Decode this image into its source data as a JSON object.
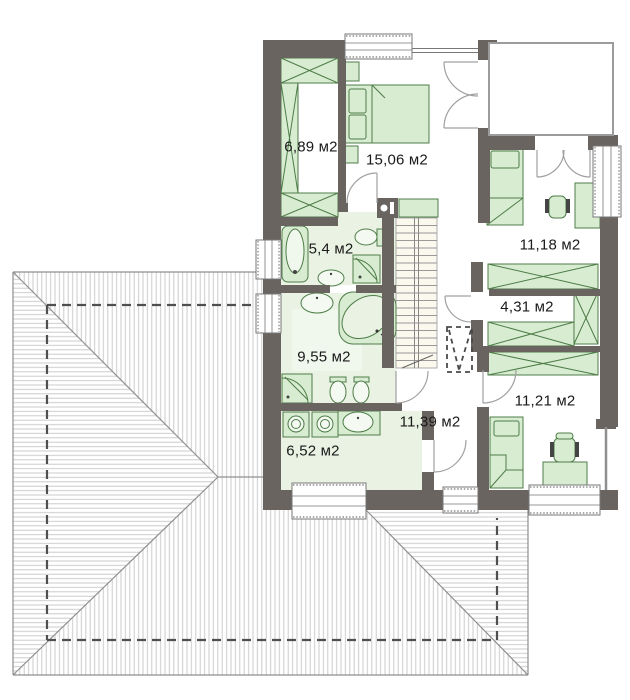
{
  "plan": {
    "area_unit": "м2",
    "rooms": [
      {
        "name": "wardrobe",
        "label": "6,89 м2"
      },
      {
        "name": "bedroom-master",
        "label": "15,06 м2"
      },
      {
        "name": "bathroom-small",
        "label": "5,4 м2"
      },
      {
        "name": "bedroom-top-right",
        "label": "11,18 м2"
      },
      {
        "name": "walk-in-closet",
        "label": "4,31 м2"
      },
      {
        "name": "bathroom-large",
        "label": "9,55 м2"
      },
      {
        "name": "hall",
        "label": "11,39 м2"
      },
      {
        "name": "bedroom-bottom-right",
        "label": "11,21 м2"
      },
      {
        "name": "laundry",
        "label": "6,52 м2"
      }
    ],
    "colors": {
      "wall": "#6a6461",
      "furniture_fill": "#d8ecd2",
      "furniture_stroke": "#4e7d48",
      "floor_tint": "#e9f2e3",
      "stairs_fill": "#fbf8ee",
      "roof_outline": "#8f8f8f",
      "roof_hatch": "#cbcbcb",
      "door_arc": "#a0a0a0",
      "text": "#1a1a1a"
    }
  }
}
